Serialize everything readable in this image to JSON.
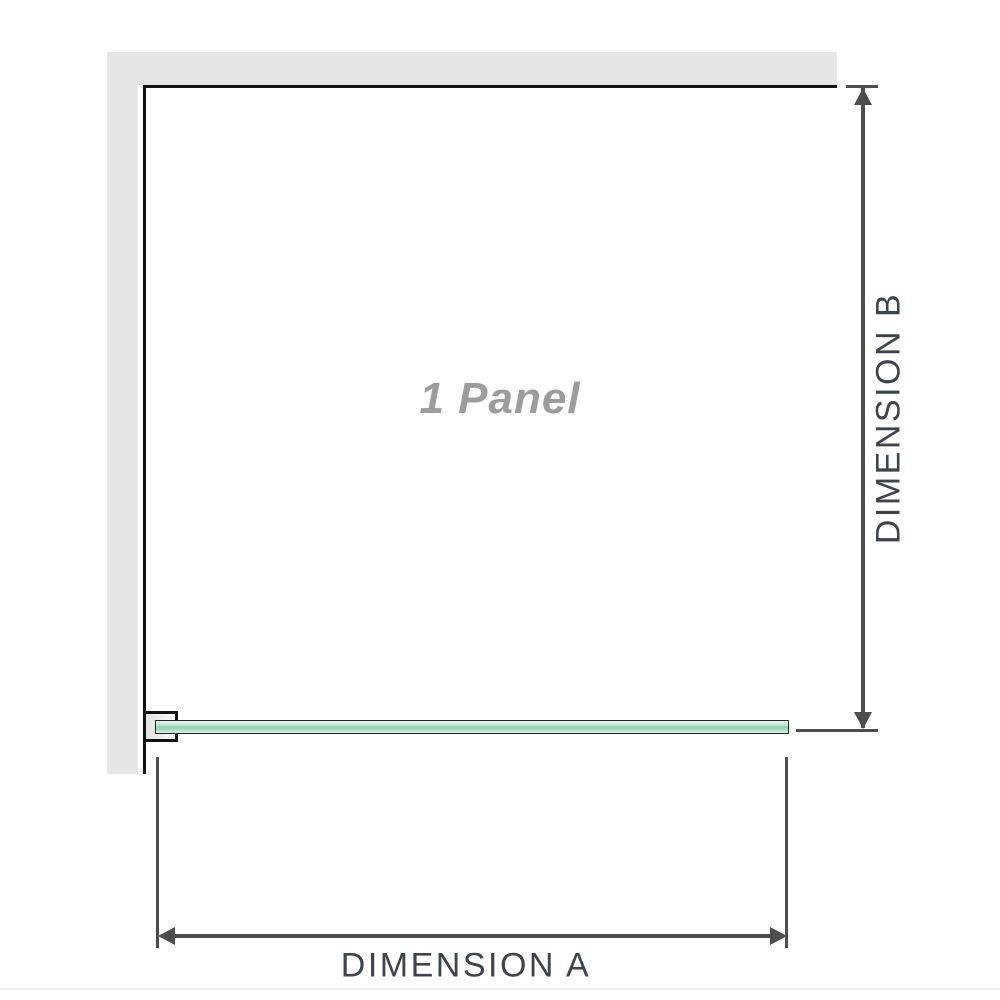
{
  "diagram": {
    "panel_label": "1 Panel",
    "dimension_a_label": "DIMENSION A",
    "dimension_b_label": "DIMENSION B"
  },
  "colors": {
    "wall": "#e6e6e6",
    "outline": "#111111",
    "dimension": "#4d4d4d",
    "label_gray": "#9c9c9c",
    "dimension_text": "#3e444c",
    "glass_light": "#e9f7f0",
    "glass_mid": "#9ad5b7",
    "glass_pale": "#d8f0e3",
    "glass_edge": "#1f2a24",
    "bracket_fill": "#e3e3e3",
    "footer_line": "#f1eaea"
  }
}
